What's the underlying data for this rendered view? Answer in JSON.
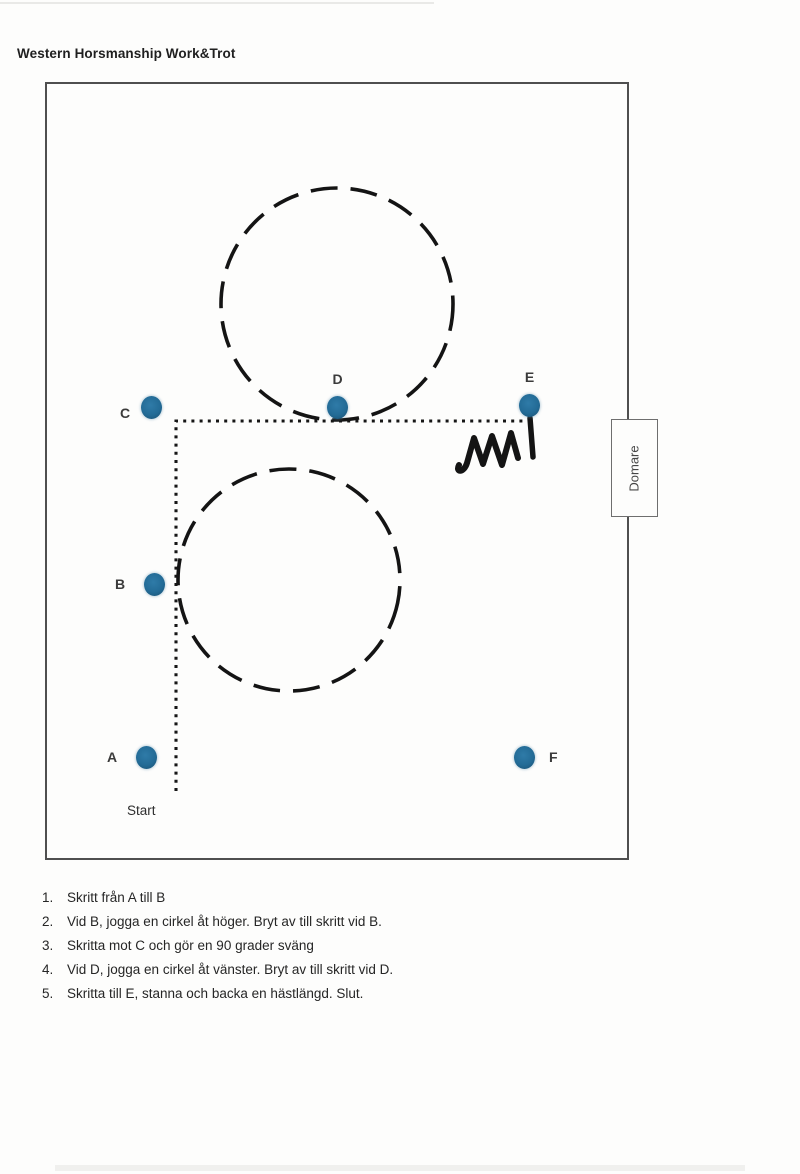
{
  "page": {
    "title": "Western Horsmanship Work&Trot"
  },
  "arena": {
    "judge_box_label": "Domare",
    "start_label": "Start",
    "markers": {
      "A": "A",
      "B": "B",
      "C": "C",
      "D": "D",
      "E": "E",
      "F": "F"
    }
  },
  "instructions": {
    "items": [
      {
        "num": "1.",
        "text": "Skritt från A till B"
      },
      {
        "num": "2.",
        "text": "Vid B, jogga en cirkel åt höger. Bryt av till skritt vid B."
      },
      {
        "num": "3.",
        "text": "Skritta mot C och gör en 90 grader sväng"
      },
      {
        "num": "4.",
        "text": "Vid D, jogga en cirkel åt vänster. Bryt av till skritt vid D."
      },
      {
        "num": "5.",
        "text": "Skritta till E, stanna och backa en hästlängd. Slut."
      }
    ]
  },
  "colors": {
    "marker_fill": "#236b96",
    "marker_edge": "#194f70",
    "arena_border": "#4f4f4f",
    "path_color": "#161616"
  }
}
